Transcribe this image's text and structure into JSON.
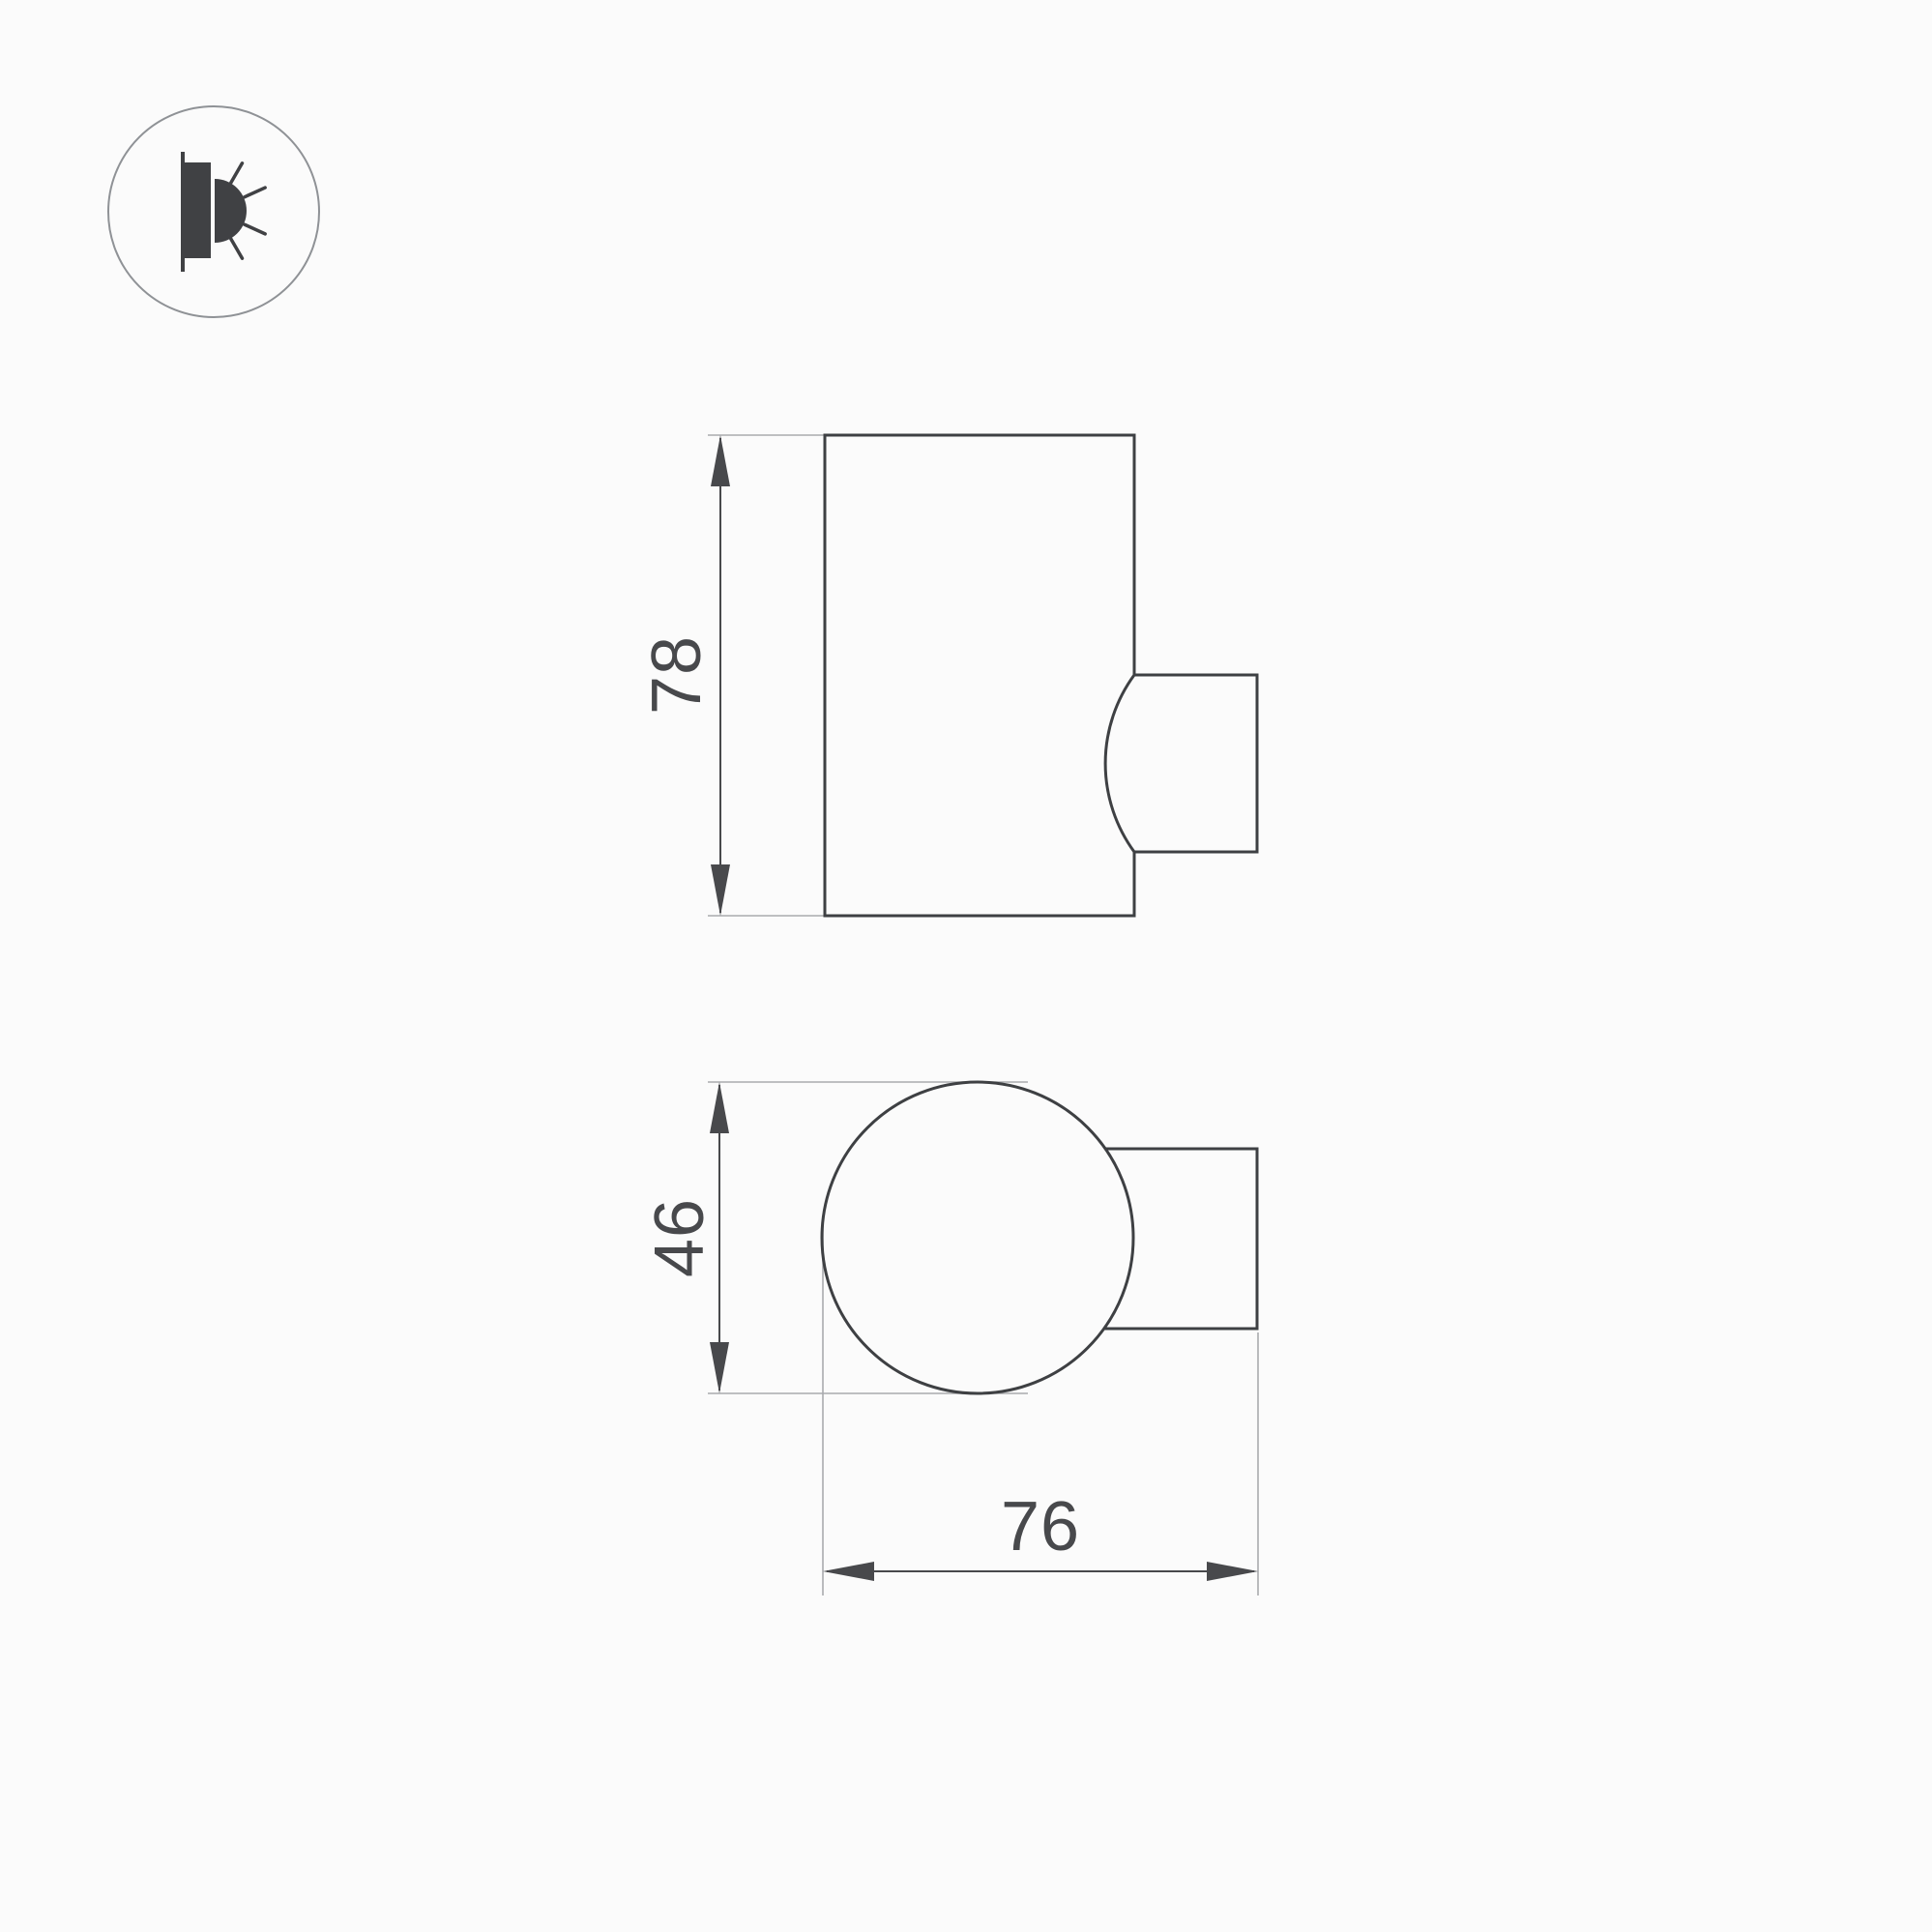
{
  "page": {
    "background": "#fbfbfb"
  },
  "colors": {
    "shape_outline": "#3e4043",
    "dimension": "#48494c",
    "extension_line": "#a9abae",
    "icon_glyph": "#404144",
    "icon_ring": "#8f9296"
  },
  "icon": {
    "name": "wall-light-side-emission"
  },
  "dimensions": {
    "side_height": "78",
    "top_diameter": "46",
    "top_depth": "76"
  }
}
